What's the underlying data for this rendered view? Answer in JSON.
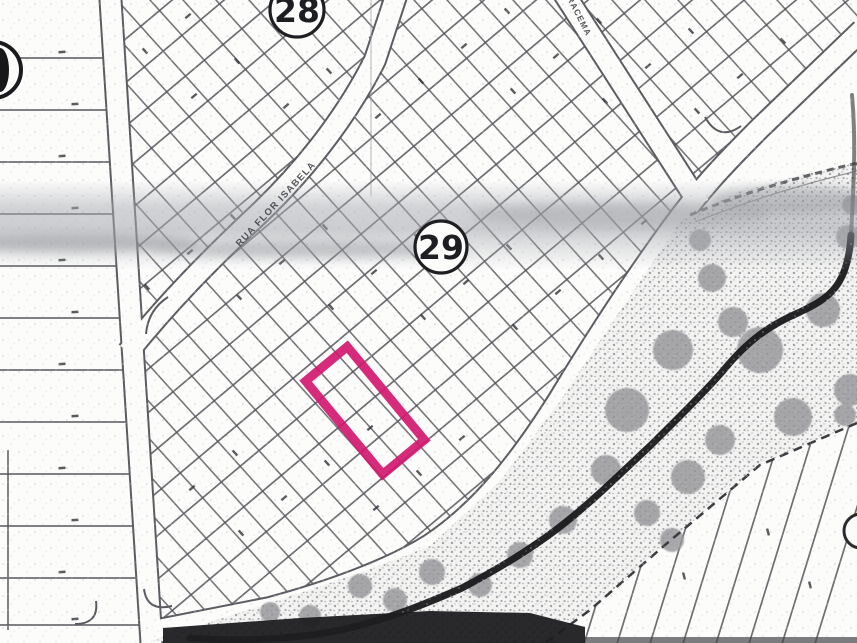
{
  "map": {
    "block_labels": [
      {
        "number": "28"
      },
      {
        "number": "29"
      }
    ],
    "street_labels": [
      {
        "name": "RUA FLOR ISABELA"
      },
      {
        "name": "IRACEMA"
      }
    ],
    "highlighted_lot": {
      "outline_color": "#d2186f"
    },
    "palette": {
      "paper": "#fcfcfb",
      "line": "#5c5c62",
      "scan_band": "#a5a8ae",
      "vegetation_dot": "#a2a2a7",
      "tree": "#96969a",
      "creek": "#19191b",
      "bottom_band": "#1d1d21"
    }
  }
}
